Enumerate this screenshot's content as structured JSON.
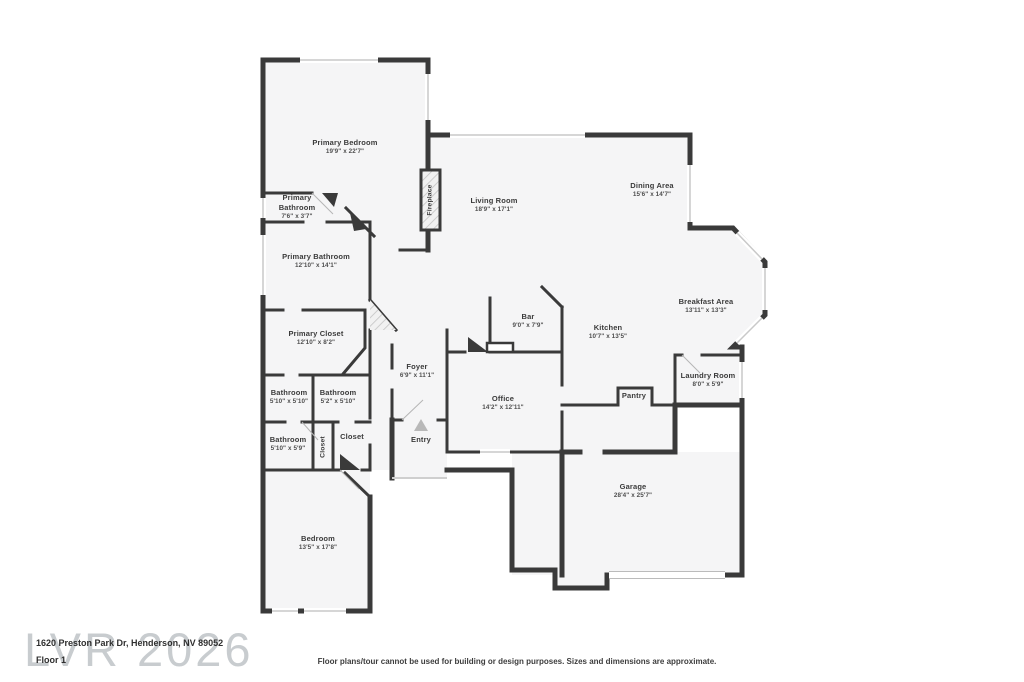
{
  "colors": {
    "wall": "#3a3a3a",
    "room_fill": "#f5f5f6",
    "window": "#c9c9c9",
    "watermark": "rgba(145,153,160,0.5)",
    "entry_arrow": "#b8b8b8"
  },
  "rooms": [
    {
      "name": "Primary Bedroom",
      "dims": "19'9\" x 22'7\""
    },
    {
      "name": "Primary Bathroom",
      "dims": "7'6\" x 3'7\""
    },
    {
      "name": "Primary Bathroom",
      "dims": "12'10\" x 14'1\""
    },
    {
      "name": "Primary Closet",
      "dims": "12'10\" x 8'2\""
    },
    {
      "name": "Bathroom",
      "dims": "5'10\" x 5'10\""
    },
    {
      "name": "Bathroom",
      "dims": "5'2\" x 5'10\""
    },
    {
      "name": "Bathroom",
      "dims": "5'10\" x 5'9\""
    },
    {
      "name": "Closet",
      "dims": ""
    },
    {
      "name": "Closet",
      "dims": ""
    },
    {
      "name": "Bedroom",
      "dims": "13'5\" x 17'8\""
    },
    {
      "name": "Foyer",
      "dims": "6'9\" x 11'1\""
    },
    {
      "name": "Office",
      "dims": "14'2\" x 12'11\""
    },
    {
      "name": "Living Room",
      "dims": "18'9\" x 17'1\""
    },
    {
      "name": "Dining Area",
      "dims": "15'6\" x 14'7\""
    },
    {
      "name": "Breakfast Area",
      "dims": "13'11\" x 13'3\""
    },
    {
      "name": "Kitchen",
      "dims": "10'7\" x 13'5\""
    },
    {
      "name": "Bar",
      "dims": "9'0\" x 7'9\""
    },
    {
      "name": "Pantry",
      "dims": ""
    },
    {
      "name": "Laundry Room",
      "dims": "8'0\" x 5'9\""
    },
    {
      "name": "Garage",
      "dims": "28'4\" x 25'7\""
    },
    {
      "name": "Fireplace",
      "dims": ""
    },
    {
      "name": "Entry",
      "dims": ""
    }
  ],
  "watermark": "LVR 2026",
  "footer": {
    "address": "1620 Preston Park Dr, Henderson, NV 89052",
    "floor": "Floor 1",
    "disclaimer": "Floor plans/tour cannot be used for building or design purposes. Sizes and dimensions are approximate."
  }
}
